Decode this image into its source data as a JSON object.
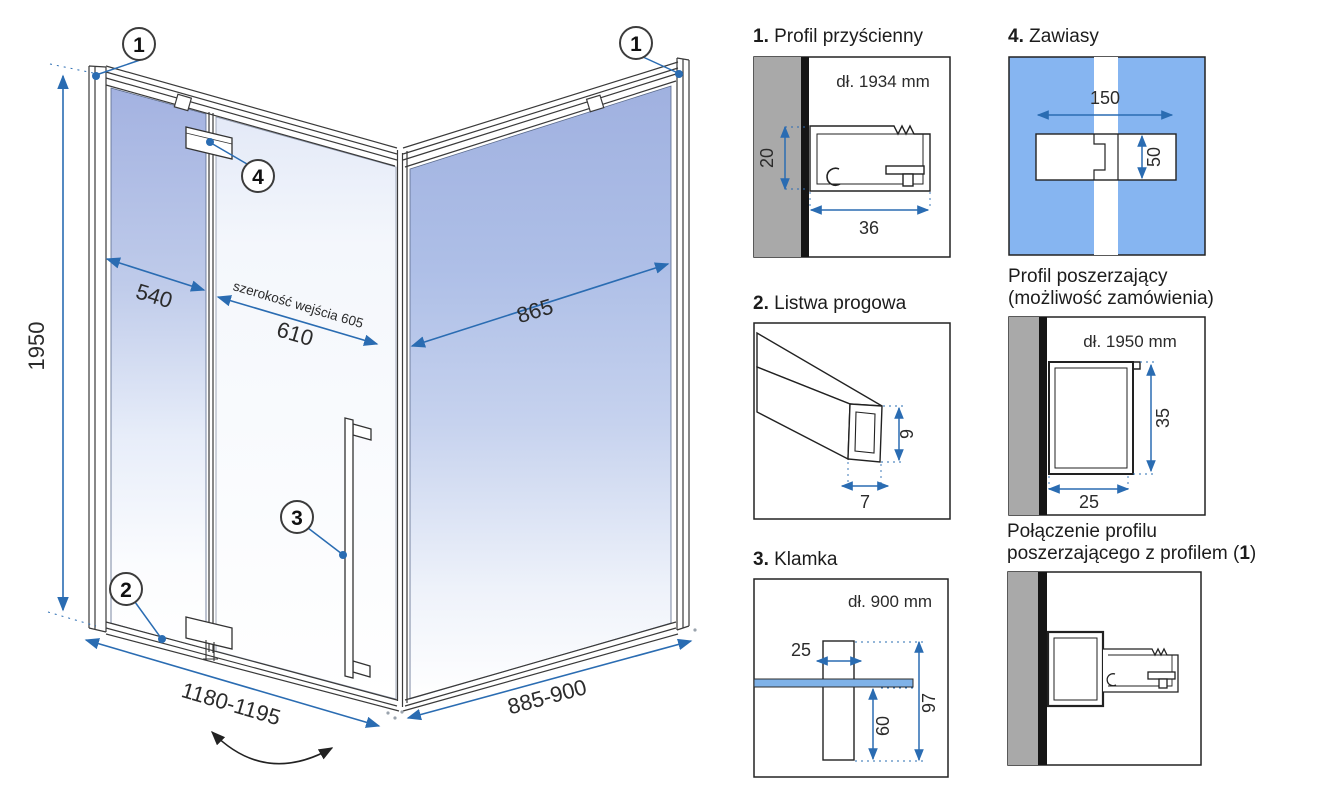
{
  "main": {
    "callouts": {
      "c1": "1",
      "c2": "2",
      "c3": "3",
      "c4": "4"
    },
    "dims": {
      "height": "1950",
      "fixed_panel": "540",
      "entry_label": "szerokość wejścia 605",
      "door_width": "610",
      "side_glass": "865",
      "front_width": "1180-1195",
      "side_width": "885-900"
    }
  },
  "panels": {
    "wall_profile": {
      "num": "1.",
      "title": " Profil przyścienny",
      "length": "dł. 1934 mm",
      "height": "20",
      "width": "36"
    },
    "hinges": {
      "num": "4.",
      "title": " Zawiasy",
      "width": "150",
      "height": "50"
    },
    "threshold": {
      "num": "2.",
      "title": " Listwa progowa",
      "height": "9",
      "width": "7"
    },
    "extension": {
      "title_line1": "Profil poszerzający",
      "title_line2": "(możliwość zamówienia)",
      "length": "dł. 1950 mm",
      "height": "35",
      "width": "25"
    },
    "handle": {
      "num": "3.",
      "title": " Klamka",
      "length": "dł. 900 mm",
      "width": "25",
      "inner": "60",
      "total": "97"
    },
    "connection": {
      "title_line1": "Połączenie profilu",
      "title_line2_pre": "poszerzającego z profilem (",
      "title_num": "1",
      "title_line2_post": ")"
    }
  },
  "colors": {
    "dimension_blue": "#2a6cb2",
    "glass_blue": "#a6b5e3",
    "hinge_panel_blue": "#86b5f1",
    "glass_strip_blue": "#7fb2e8",
    "wall_gray": "#a9a9a9",
    "outline": "#333333"
  }
}
